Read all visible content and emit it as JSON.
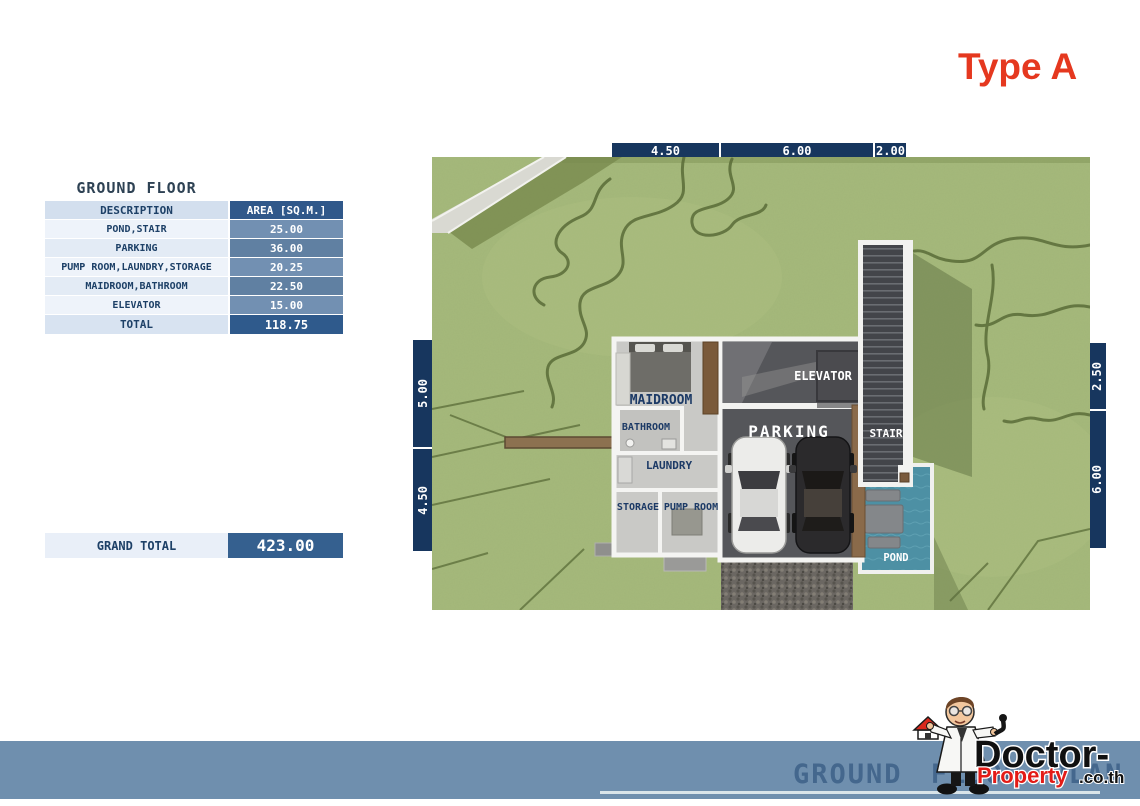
{
  "title": "Type A",
  "table": {
    "title": "GROUND FLOOR",
    "col_description": "DESCRIPTION",
    "col_area": "AREA [SQ.M.]",
    "rows": [
      {
        "description": "POND,STAIR",
        "area": "25.00"
      },
      {
        "description": "PARKING",
        "area": "36.00"
      },
      {
        "description": "PUMP ROOM,LAUNDRY,STORAGE",
        "area": "20.25"
      },
      {
        "description": "MAIDROOM,BATHROOM",
        "area": "22.50"
      },
      {
        "description": "ELEVATOR",
        "area": "15.00"
      }
    ],
    "total_label": "TOTAL",
    "total_area": "118.75"
  },
  "grand_total": {
    "label": "GRAND TOTAL",
    "value": "423.00"
  },
  "dimensions": {
    "top": [
      "4.50",
      "6.00",
      "2.00"
    ],
    "left": [
      "5.00",
      "4.50"
    ],
    "right": [
      "2.50",
      "6.00"
    ]
  },
  "plan_labels": {
    "maidroom": "MAIDROOM",
    "bathroom": "BATHROOM",
    "laundry": "LAUNDRY",
    "storage": "STORAGE",
    "pump_room": "PUMP ROOM",
    "elevator": "ELEVATOR",
    "parking": "PARKING",
    "stair": "STAIR",
    "pond": "POND"
  },
  "footer": {
    "caption": "GROUND FLOOR PLAN"
  },
  "logo": {
    "icon": "doctor-with-house-icon",
    "line1": "Doctor-",
    "line2": "Property",
    "suffix": ".co.th"
  },
  "colors": {
    "accent_red": "#e5381f",
    "dimension_navy": "#17365e",
    "table_header_blue": "#30588a",
    "table_cell_blue": "#7290b2",
    "footer_bar_blue": "#6f8fae",
    "pond_teal": "#4d90a4",
    "grass_green": "#a5b97b"
  }
}
